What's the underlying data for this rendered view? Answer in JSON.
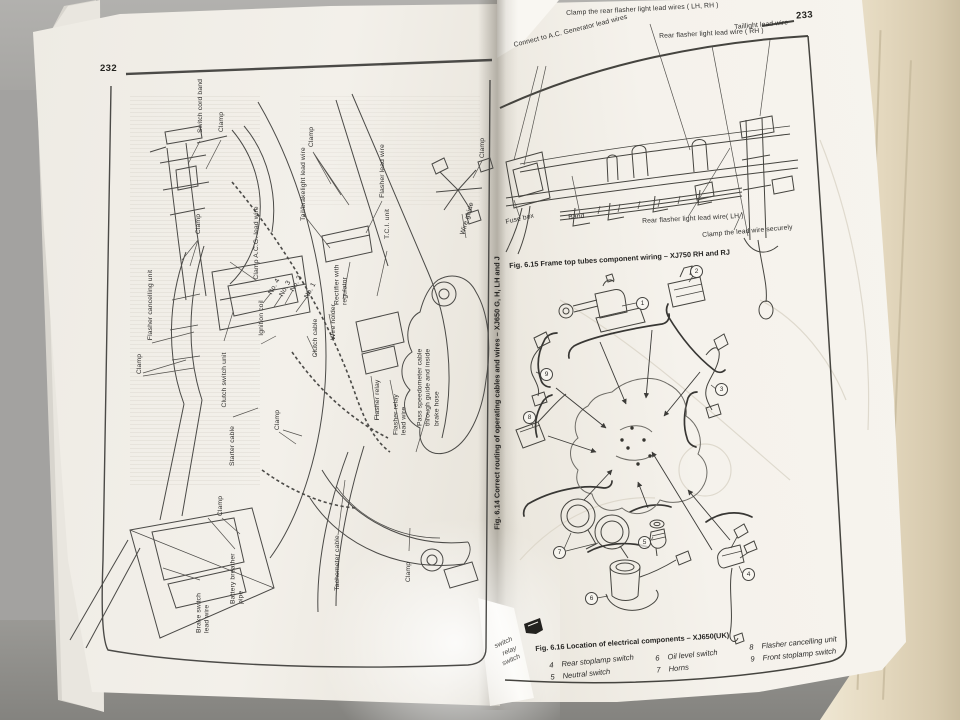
{
  "colors": {
    "paper": "#f3f0ea",
    "ink": "#3c3c3c",
    "table_gray": "#8e8d8a",
    "page_stack_cream": "#e3d7bd",
    "wall_blue_gray": "#a9aeb8"
  },
  "left_page": {
    "page_number": "232",
    "fig_614": {
      "caption": "Fig. 6.14 Correct routing of operating cables and wires – XJ650 G, H, LH and J"
    },
    "labels": [
      "Switch cord band",
      "Clamp",
      "Clamp",
      "Clamp A.C.G. lead wire",
      "Flasher cancelling unit",
      "Clamp",
      "Clutch switch unit",
      "Ignition coil",
      "No. 4",
      "No. 3",
      "No. 2",
      "No. 1",
      "Starter cable",
      "Clamp",
      "Clamp",
      "Battery breather pipe",
      "Brake switch lead wire",
      "Tachometer cable",
      "Clamp",
      "Clamp",
      "Tail/brakelight lead wire",
      "Flasher lead wire",
      "T.C.I. unit",
      "Rectifier with regulator",
      "Wire holder",
      "Clutch cable",
      "Flasher relay",
      "Flasher relay lead wire",
      "Pass speedometer cable through guide and inside brake hose",
      "Wire guide",
      "Clamp"
    ]
  },
  "right_page": {
    "page_number": "233",
    "fig_615": {
      "caption": "Fig. 6.15 Frame top tubes component wiring – XJ750 RH and RJ",
      "labels": [
        "Clamp the rear flasher light lead wires ( LH, RH )",
        "Taillight lead wire",
        "Rear flasher light lead wire ( RH )",
        "Connect to A.C. Generator lead wires",
        "Fuse box",
        "Band",
        "Rear flasher light lead wire( LH )",
        "Clamp the lead wire securely"
      ]
    },
    "fig_616": {
      "caption": "Fig. 6.16 Location of electrical components – XJ650(UK)",
      "callouts": [
        "1",
        "2",
        "3",
        "4",
        "5",
        "6",
        "7",
        "8",
        "9"
      ],
      "legend": [
        {
          "num": "4",
          "label": "Rear stoplamp switch"
        },
        {
          "num": "5",
          "label": "Neutral switch"
        },
        {
          "num": "6",
          "label": "Oil level switch"
        },
        {
          "num": "7",
          "label": "Horns"
        },
        {
          "num": "8",
          "label": "Flasher cancelling unit"
        },
        {
          "num": "9",
          "label": "Front stoplamp switch"
        }
      ],
      "legend_cutoff": [
        "switch",
        "relay",
        "switch"
      ]
    }
  }
}
